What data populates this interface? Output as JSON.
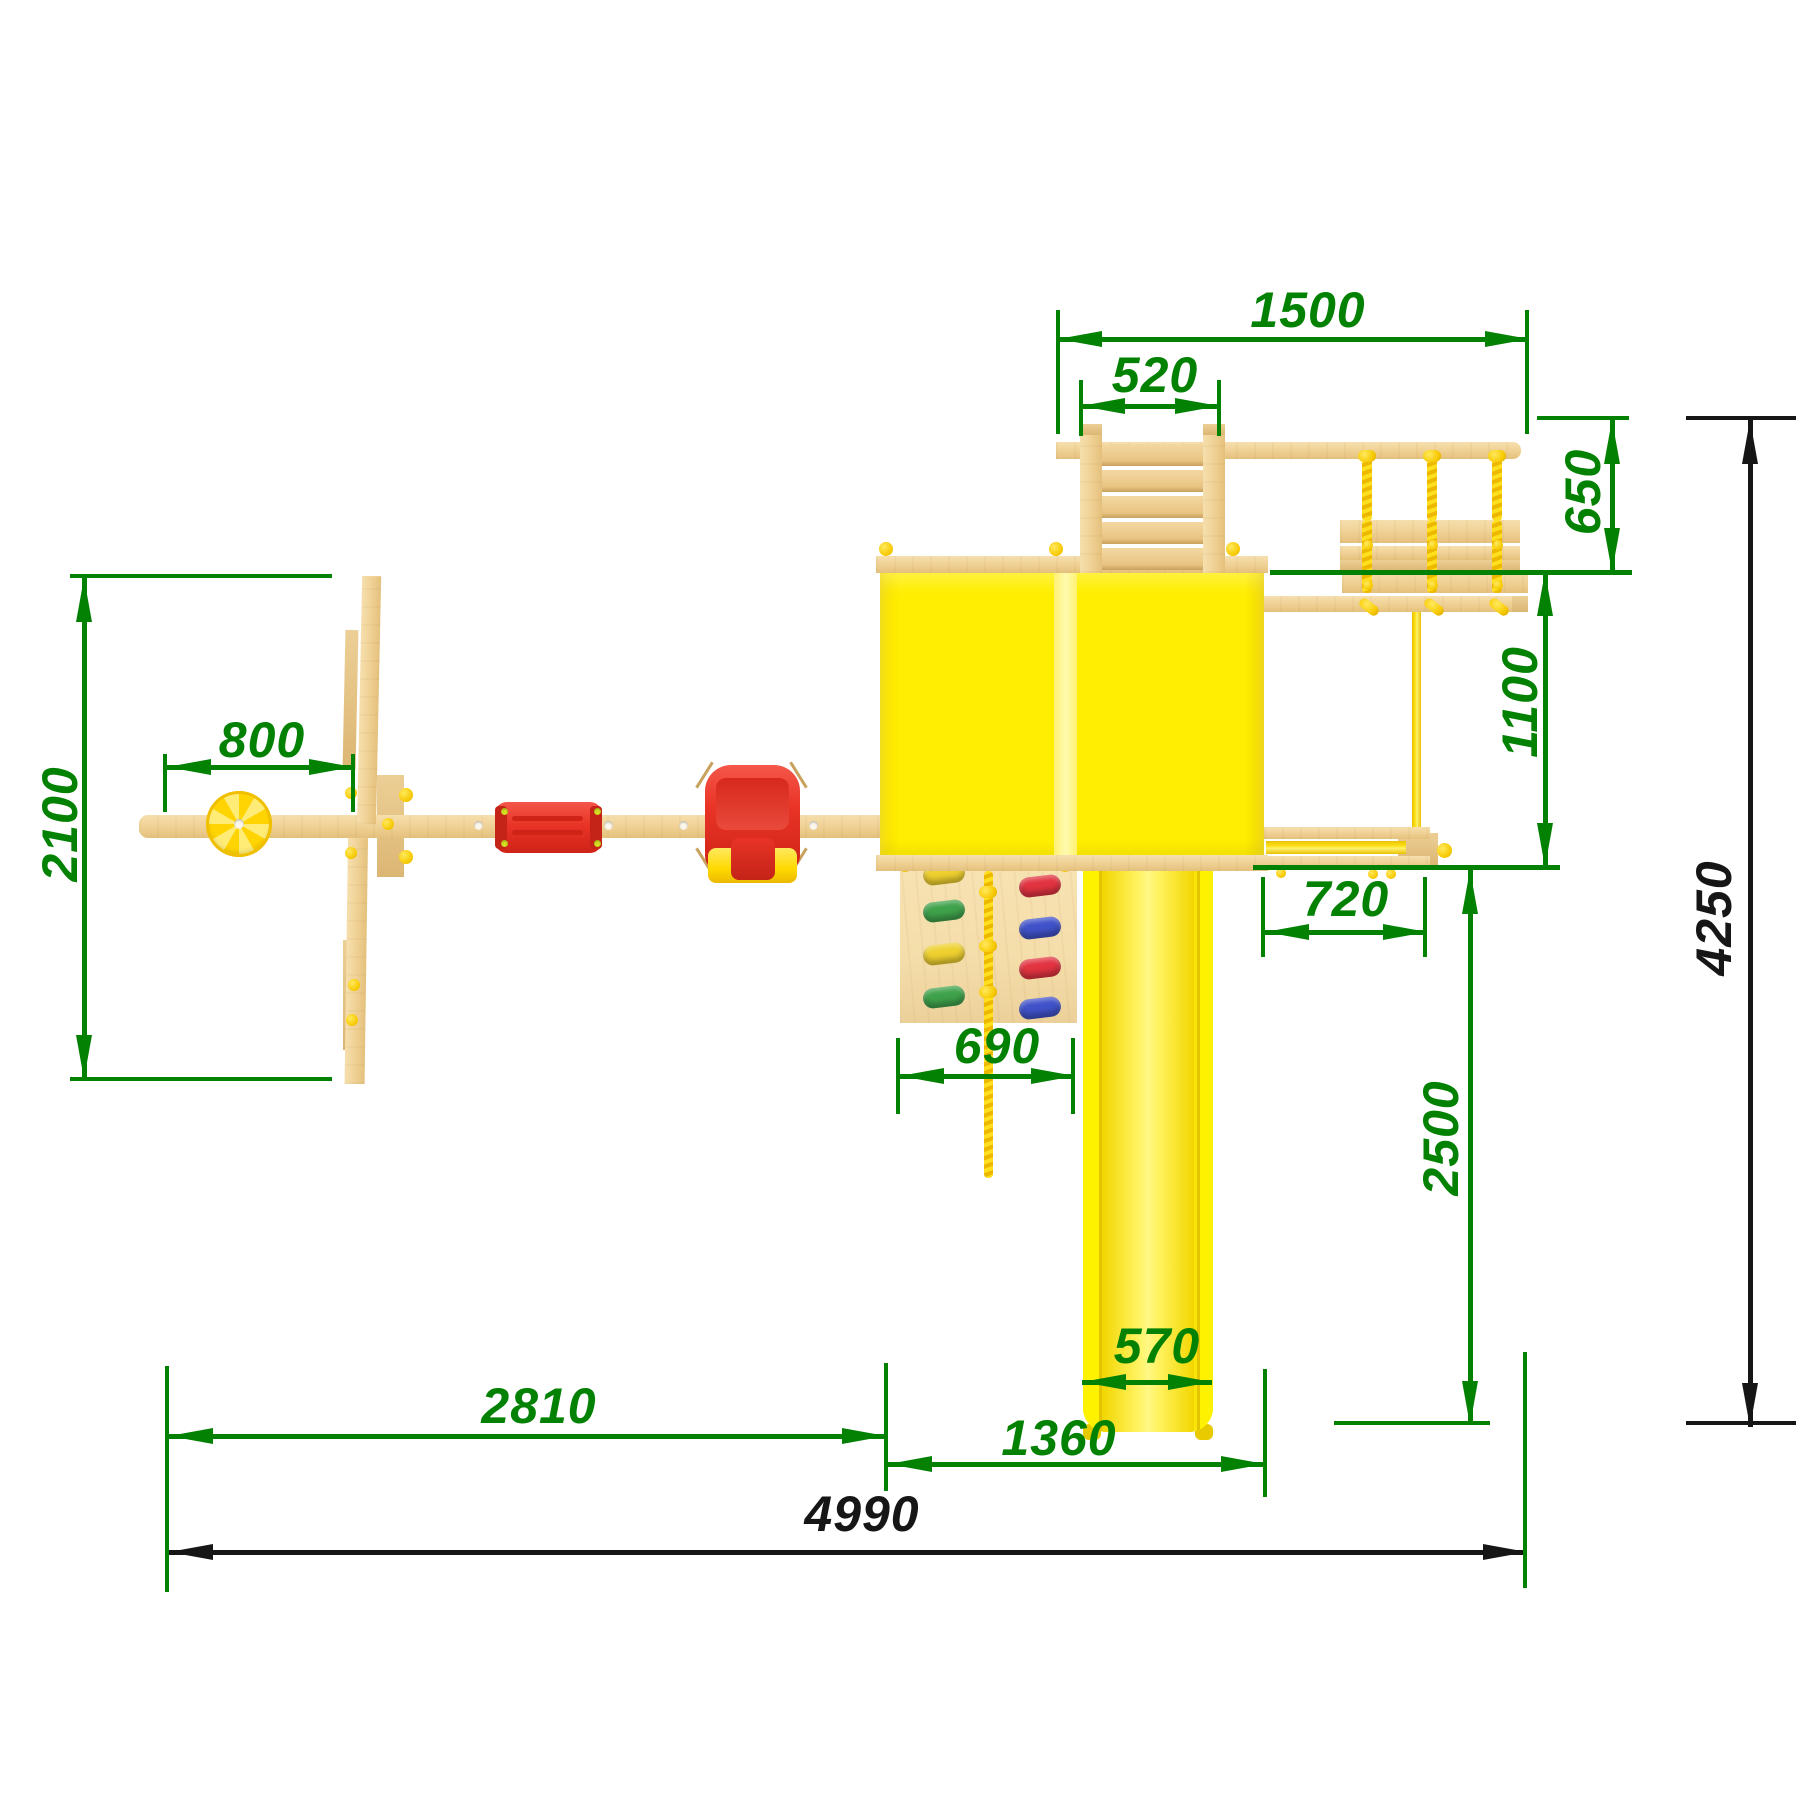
{
  "drawing": {
    "subject": "playground-set-top-view-dimension-drawing"
  },
  "dims": {
    "d1500": "1500",
    "d520": "520",
    "d650": "650",
    "d1100": "1100",
    "d2100": "2100",
    "d800": "800",
    "d690": "690",
    "d720": "720",
    "d2500": "2500",
    "d570": "570",
    "d1360": "1360",
    "d2810": "2810",
    "d4990": "4990",
    "d4250": "4250"
  },
  "colors": {
    "green": "#038103",
    "black": "#161616",
    "bg": "#ffffff",
    "wood": "#efd093",
    "wood_dark": "#dcb673",
    "plywood": "#f4dda9",
    "roof_yellow": "#ffee00",
    "roof_ridge": "#fffbb0",
    "slide_yellow": "#fbe40a",
    "rope_yellow": "#ffdf1e",
    "cap_yellow": "#f7c900",
    "seat_red": "#e93427",
    "hold_green": "#3fa24b",
    "hold_yellow": "#eed02f",
    "hold_red": "#e23340",
    "hold_blue": "#4052c9"
  }
}
